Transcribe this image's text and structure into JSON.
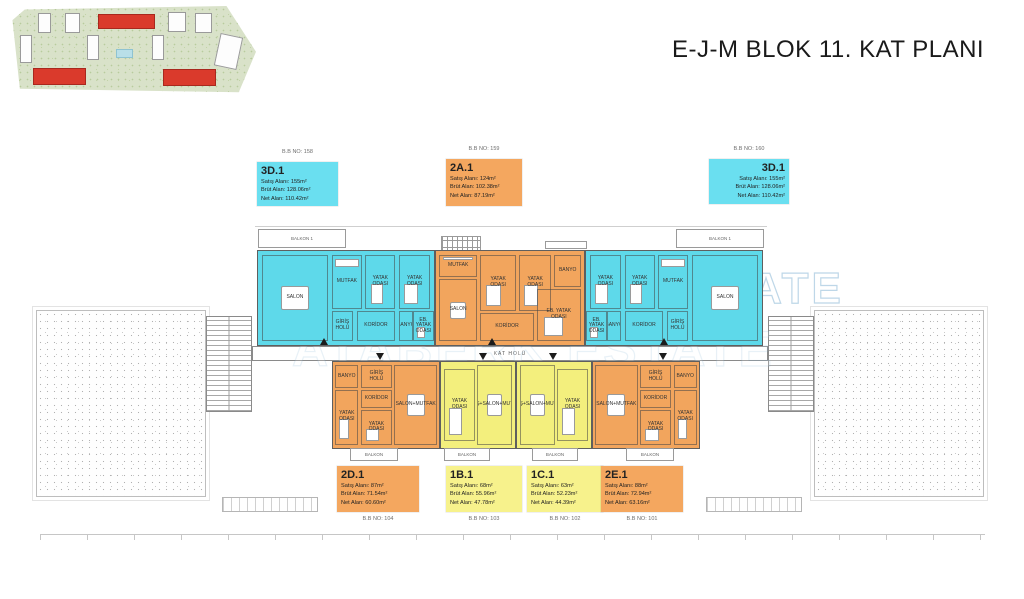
{
  "page": {
    "title": "E-J-M BLOK 11. KAT PLANI"
  },
  "watermark": {
    "line1": "ATABERK ESTATE"
  },
  "info_boxes": {
    "top": [
      {
        "code": "3D.1",
        "bb_no": "B.B NO: 158",
        "lines": [
          "Satış Alanı: 155m²",
          "Brüt Alan: 128.06m²",
          "Net Alan: 110.42m²"
        ],
        "color": "#6ADFF0",
        "align": "left"
      },
      {
        "code": "2A.1",
        "bb_no": "B.B NO: 159",
        "lines": [
          "Satış Alanı: 124m²",
          "Brüt Alan: 102.38m²",
          "Net Alan: 87.19m²"
        ],
        "color": "#F4A75F",
        "align": "left"
      },
      {
        "code": "3D.1",
        "bb_no": "B.B NO: 160",
        "lines": [
          "Satış Alanı: 155m²",
          "Brüt Alan: 128.06m²",
          "Net Alan: 110.42m²"
        ],
        "color": "#6ADFF0",
        "align": "right"
      }
    ],
    "bottom": [
      {
        "code": "2D.1",
        "bb_no": "B.B NO: 104",
        "lines": [
          "Satış Alanı: 87m²",
          "Brüt Alan: 71.54m²",
          "Net Alan: 60.60m²"
        ],
        "color": "#F4A75F",
        "align": "left"
      },
      {
        "code": "1B.1",
        "bb_no": "B.B NO: 103",
        "lines": [
          "Satış Alanı: 68m²",
          "Brüt Alan: 55.96m²",
          "Net Alan: 47.78m²"
        ],
        "color": "#F7F28C",
        "align": "left"
      },
      {
        "code": "1C.1",
        "bb_no": "B.B NO: 102",
        "lines": [
          "Satış Alanı: 63m²",
          "Brüt Alan: 52.23m²",
          "Net Alan: 44.39m²"
        ],
        "color": "#F7F28C",
        "align": "left"
      },
      {
        "code": "2E.1",
        "bb_no": "B.B NO: 101",
        "lines": [
          "Satış Alanı: 88m²",
          "Brüt Alan: 72.94m²",
          "Net Alan: 63.16m²"
        ],
        "color": "#F4A75F",
        "align": "left"
      }
    ]
  },
  "floor_plan": {
    "corridor_label": "KAT HOLÜ",
    "balcony_top_label": "BALKON 1",
    "balcony_bottom_label": "BALKON",
    "colors": {
      "cyan": "#5ED9EA",
      "orange": "#F2A55D",
      "yellow": "#F3EF7D"
    },
    "apartments": [
      {
        "unit": "3D.1",
        "rooms": [
          "SALON",
          "MUTFAK",
          "YATAK ODASI",
          "YATAK ODASI",
          "GİRİŞ HOLÜ",
          "KORİDOR",
          "BANYO",
          "EB. YATAK ODASI"
        ]
      },
      {
        "unit": "2A.1",
        "rooms": [
          "MUTFAK",
          "SALON",
          "YATAK ODASI",
          "YATAK ODASI",
          "KORİDOR",
          "EB. YATAK ODASI",
          "BANYO"
        ]
      },
      {
        "unit": "3D.1",
        "rooms": [
          "EB. YATAK ODASI",
          "BANYO",
          "KORİDOR",
          "GİRİŞ HOLÜ",
          "YATAK ODASI",
          "YATAK ODASI",
          "MUTFAK",
          "SALON"
        ]
      },
      {
        "unit": "2D.1",
        "rooms": [
          "BANYO",
          "GİRİŞ HOLÜ",
          "KORİDOR",
          "YATAK ODASI",
          "YATAK ODASI",
          "SALON+MUTFAK"
        ]
      },
      {
        "unit": "1B.1",
        "rooms": [
          "YATAK ODASI",
          "GİRİŞ+SALON+MUTFAK"
        ]
      },
      {
        "unit": "1C.1",
        "rooms": [
          "GİRİŞ+SALON+MUTFAK",
          "YATAK ODASI"
        ]
      },
      {
        "unit": "2E.1",
        "rooms": [
          "SALON+MUTFAK",
          "GİRİŞ HOLÜ",
          "KORİDOR",
          "BANYO",
          "YATAK ODASI",
          "YATAK ODASI"
        ]
      }
    ]
  },
  "site_plan": {
    "highlight_color": "#DA3A2C"
  }
}
